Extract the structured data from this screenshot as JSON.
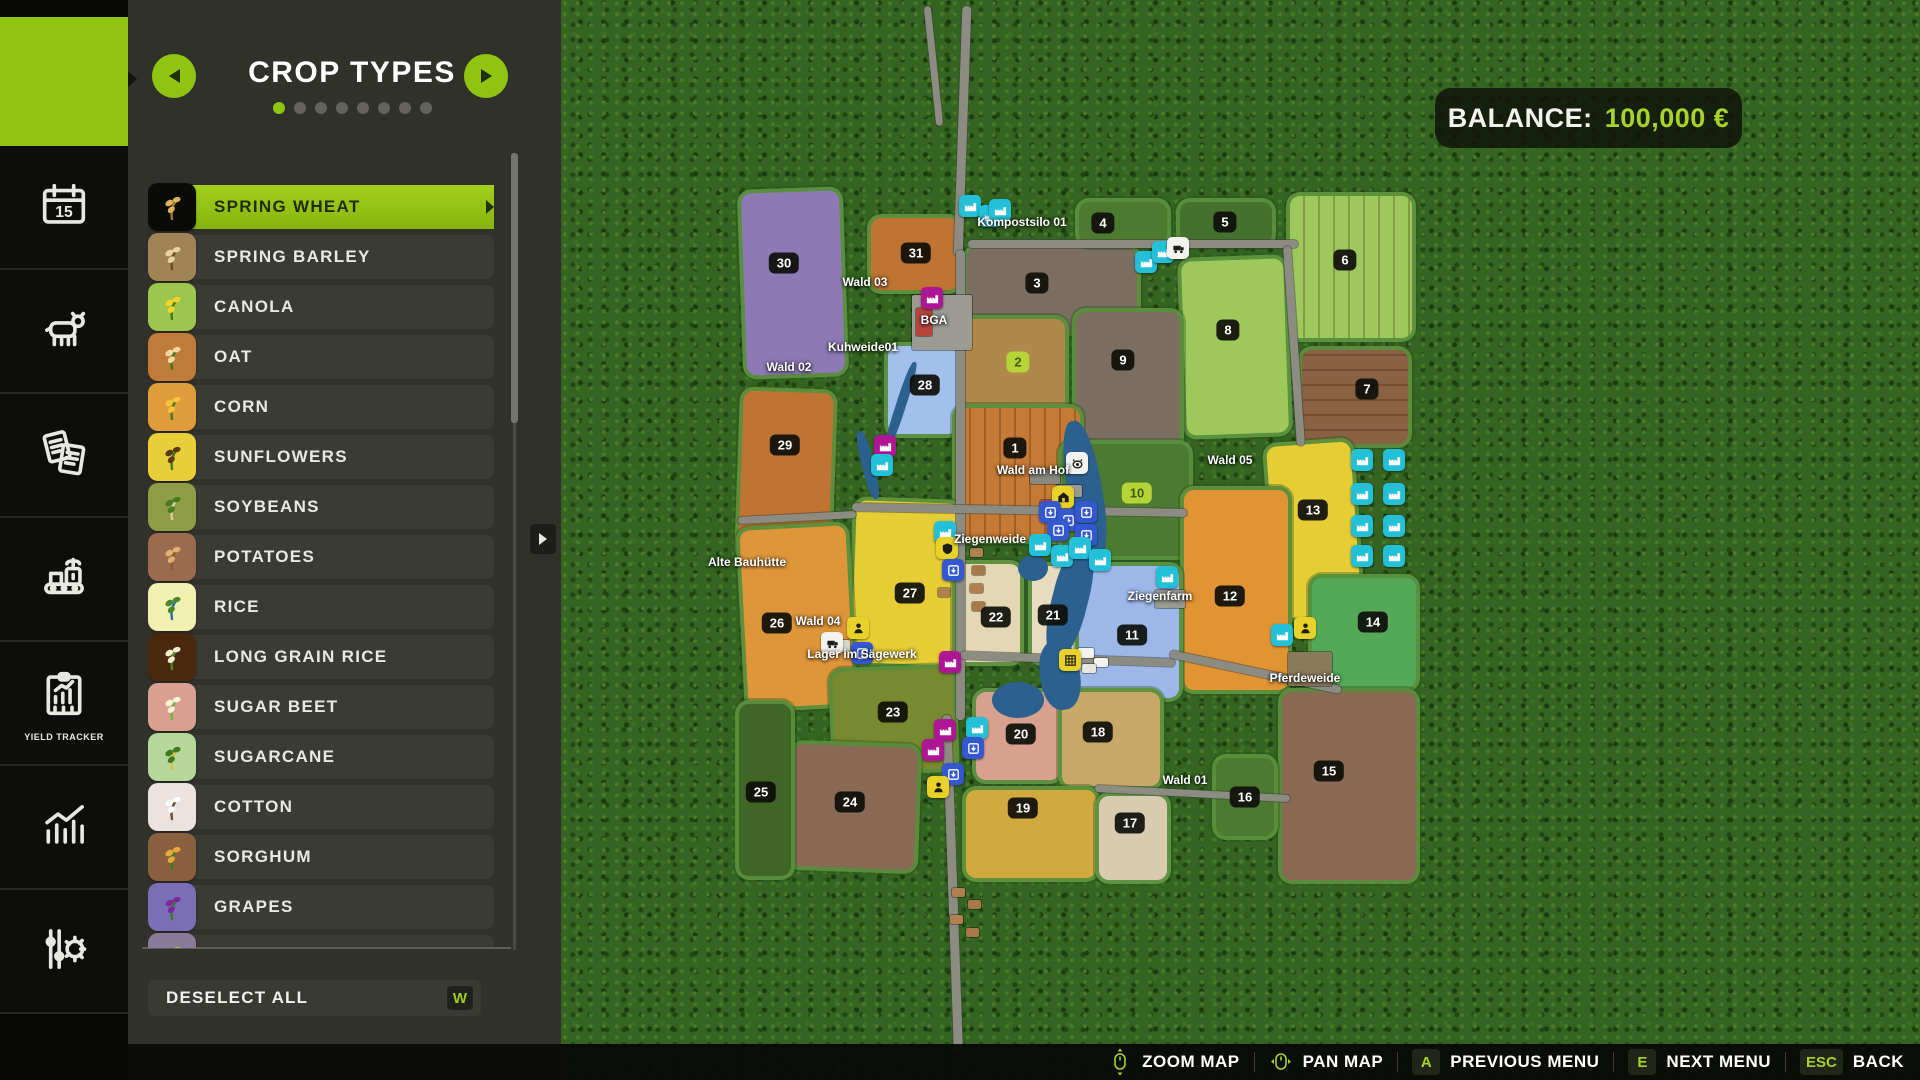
{
  "sidebar": {
    "items": [
      {
        "id": "map",
        "active": true
      },
      {
        "id": "calendar"
      },
      {
        "id": "animals"
      },
      {
        "id": "contracts"
      },
      {
        "id": "production"
      },
      {
        "id": "yield-tracker",
        "label": "YIELD TRACKER"
      },
      {
        "id": "statistics"
      },
      {
        "id": "settings"
      }
    ]
  },
  "panel": {
    "title": "CROP TYPES",
    "dots": {
      "count": 8,
      "active": 0
    },
    "accent": "#8fc412",
    "crops": [
      {
        "label": "SPRING WHEAT",
        "icon": "wheat-icon",
        "tile": "#0a0a08",
        "accent": "#d8b35a",
        "accent2": "#a07c2a",
        "selected": true
      },
      {
        "label": "SPRING BARLEY",
        "icon": "barley-icon",
        "tile": "#a08455",
        "accent": "#e9d3a0",
        "accent2": "#6b4e1e"
      },
      {
        "label": "CANOLA",
        "icon": "canola-icon",
        "tile": "#9dc64f",
        "accent": "#f5d42a",
        "accent2": "#3f7a1f"
      },
      {
        "label": "OAT",
        "icon": "oat-icon",
        "tile": "#c07a3a",
        "accent": "#f0d9a0",
        "accent2": "#3f7a1f"
      },
      {
        "label": "CORN",
        "icon": "corn-icon",
        "tile": "#e09b3a",
        "accent": "#f7c43a",
        "accent2": "#3f7a1f"
      },
      {
        "label": "SUNFLOWERS",
        "icon": "sunflower-icon",
        "tile": "#e8cf3a",
        "accent": "#5a3a10",
        "accent2": "#3f7a1f"
      },
      {
        "label": "SOYBEANS",
        "icon": "soybean-icon",
        "tile": "#8f9e44",
        "accent": "#4a7a1f",
        "accent2": "#d9cfa0"
      },
      {
        "label": "POTATOES",
        "icon": "potato-icon",
        "tile": "#9c6b4f",
        "accent": "#e0b070",
        "accent2": "#8a5a28"
      },
      {
        "label": "RICE",
        "icon": "rice-icon",
        "tile": "#f2f0b0",
        "accent": "#4a8a2a",
        "accent2": "#2a6ab0"
      },
      {
        "label": "LONG GRAIN RICE",
        "icon": "long-grain-rice-icon",
        "tile": "#4a2810",
        "accent": "#f0eecc",
        "accent2": "#4a8a2a"
      },
      {
        "label": "SUGAR BEET",
        "icon": "sugar-beet-icon",
        "tile": "#d9a091",
        "accent": "#f7f3d9",
        "accent2": "#7ab040"
      },
      {
        "label": "SUGARCANE",
        "icon": "sugarcane-icon",
        "tile": "#b5d89a",
        "accent": "#3f7a1f",
        "accent2": "#d9c040"
      },
      {
        "label": "COTTON",
        "icon": "cotton-icon",
        "tile": "#ece2e0",
        "accent": "#ffffff",
        "accent2": "#6b4e2e"
      },
      {
        "label": "SORGHUM",
        "icon": "sorghum-icon",
        "tile": "#8a5f3f",
        "accent": "#e8a83a",
        "accent2": "#3f7a1f"
      },
      {
        "label": "GRAPES",
        "icon": "grapes-icon",
        "tile": "#7a6fb5",
        "accent": "#7a2a9a",
        "accent2": "#3f7a1f"
      },
      {
        "label": "OLIVES",
        "icon": "olives-icon",
        "tile": "#8a7a9a",
        "accent": "#b8c030",
        "accent2": "#3f7a1f"
      }
    ],
    "deselect_label": "DESELECT ALL",
    "deselect_key": "W"
  },
  "balance": {
    "label": "BALANCE:",
    "value": "100,000 €",
    "value_color": "#a6d32a"
  },
  "bottom_bar": {
    "items": [
      {
        "icon": "mouse-zoom-icon",
        "label": "ZOOM MAP"
      },
      {
        "icon": "mouse-pan-icon",
        "label": "PAN MAP"
      },
      {
        "key": "A",
        "label": "PREVIOUS MENU"
      },
      {
        "key": "E",
        "label": "NEXT MENU"
      },
      {
        "key": "ESC",
        "label": "BACK"
      }
    ]
  },
  "map": {
    "fields": [
      {
        "n": "30",
        "x": 740,
        "y": 188,
        "w": 106,
        "h": 190,
        "c": "#8d7ab5",
        "bx": 784,
        "by": 263,
        "rot": -2
      },
      {
        "n": "31",
        "x": 867,
        "y": 214,
        "w": 95,
        "h": 80,
        "c": "#c07433",
        "bx": 916,
        "by": 253
      },
      {
        "n": "3",
        "x": 963,
        "y": 244,
        "w": 178,
        "h": 92,
        "c": "#7b6f62",
        "bx": 1037,
        "by": 283
      },
      {
        "n": "4",
        "x": 1075,
        "y": 198,
        "w": 96,
        "h": 50,
        "c": "#4c7a31",
        "bx": 1103,
        "by": 223
      },
      {
        "n": "5",
        "x": 1176,
        "y": 198,
        "w": 100,
        "h": 50,
        "c": "#45702d",
        "bx": 1225,
        "by": 222
      },
      {
        "n": "6",
        "x": 1286,
        "y": 192,
        "w": 130,
        "h": 150,
        "c": "#9fc85c",
        "bx": 1345,
        "by": 260,
        "rows": "v"
      },
      {
        "n": "7",
        "x": 1298,
        "y": 346,
        "w": 114,
        "h": 102,
        "c": "#8a6142",
        "bx": 1367,
        "by": 389,
        "rows": "h"
      },
      {
        "n": "8",
        "x": 1180,
        "y": 256,
        "w": 110,
        "h": 182,
        "c": "#9fc85c",
        "bx": 1228,
        "by": 330,
        "rot": -2
      },
      {
        "n": "9",
        "x": 1072,
        "y": 308,
        "w": 112,
        "h": 146,
        "c": "#7b6f62",
        "bx": 1123,
        "by": 360
      },
      {
        "n": "2",
        "x": 955,
        "y": 315,
        "w": 114,
        "h": 118,
        "c": "#b0894a",
        "bx": 1018,
        "by": 362,
        "g": 1
      },
      {
        "n": "28",
        "x": 884,
        "y": 342,
        "w": 78,
        "h": 96,
        "c": "#a3bfec",
        "bx": 925,
        "by": 385
      },
      {
        "n": "29",
        "x": 737,
        "y": 388,
        "w": 98,
        "h": 175,
        "c": "#c07433",
        "bx": 785,
        "by": 445,
        "rot": 2
      },
      {
        "n": "1",
        "x": 952,
        "y": 404,
        "w": 132,
        "h": 140,
        "c": "#c57a35",
        "bx": 1015,
        "by": 448,
        "rows": "v"
      },
      {
        "n": "10",
        "x": 1058,
        "y": 440,
        "w": 135,
        "h": 120,
        "c": "#4c7a31",
        "bx": 1137,
        "by": 493,
        "g": 1
      },
      {
        "n": "13",
        "x": 1268,
        "y": 440,
        "w": 92,
        "h": 180,
        "c": "#e6cd36",
        "bx": 1313,
        "by": 510,
        "rot": -4
      },
      {
        "n": "12",
        "x": 1180,
        "y": 486,
        "w": 112,
        "h": 208,
        "c": "#e09434",
        "bx": 1230,
        "by": 596
      },
      {
        "n": "27",
        "x": 850,
        "y": 498,
        "w": 110,
        "h": 170,
        "c": "#e6cd36",
        "bx": 910,
        "by": 593,
        "rot": 2
      },
      {
        "n": "26",
        "x": 740,
        "y": 524,
        "w": 114,
        "h": 186,
        "c": "#df963a",
        "bx": 777,
        "by": 623,
        "rot": -3
      },
      {
        "n": "22",
        "x": 952,
        "y": 560,
        "w": 72,
        "h": 106,
        "c": "#e4d7b5",
        "bx": 996,
        "by": 617
      },
      {
        "n": "21",
        "x": 1028,
        "y": 562,
        "w": 52,
        "h": 104,
        "c": "#e8dcc0",
        "bx": 1053,
        "by": 615
      },
      {
        "n": "11",
        "x": 1075,
        "y": 562,
        "w": 108,
        "h": 140,
        "c": "#9db8e8",
        "bx": 1132,
        "by": 635
      },
      {
        "n": "14",
        "x": 1308,
        "y": 574,
        "w": 112,
        "h": 118,
        "c": "#55a858",
        "bx": 1373,
        "by": 622
      },
      {
        "n": "23",
        "x": 830,
        "y": 666,
        "w": 128,
        "h": 108,
        "c": "#78892f",
        "bx": 893,
        "by": 712,
        "rot": -2
      },
      {
        "n": "20",
        "x": 972,
        "y": 688,
        "w": 92,
        "h": 96,
        "c": "#d8a08f",
        "bx": 1021,
        "by": 734
      },
      {
        "n": "18",
        "x": 1058,
        "y": 688,
        "w": 106,
        "h": 102,
        "c": "#c8a869",
        "bx": 1098,
        "by": 732
      },
      {
        "n": "15",
        "x": 1278,
        "y": 688,
        "w": 142,
        "h": 196,
        "c": "#8a6a55",
        "bx": 1329,
        "by": 771
      },
      {
        "n": "16",
        "x": 1212,
        "y": 754,
        "w": 66,
        "h": 86,
        "c": "#4c7a31",
        "bx": 1245,
        "by": 797
      },
      {
        "n": "24",
        "x": 788,
        "y": 742,
        "w": 132,
        "h": 130,
        "c": "#8a6a55",
        "bx": 850,
        "by": 802,
        "rot": 2
      },
      {
        "n": "25",
        "x": 735,
        "y": 700,
        "w": 60,
        "h": 180,
        "c": "#3f6527",
        "bx": 761,
        "by": 792
      },
      {
        "n": "19",
        "x": 962,
        "y": 786,
        "w": 138,
        "h": 96,
        "c": "#d0a93f",
        "bx": 1023,
        "by": 808
      },
      {
        "n": "17",
        "x": 1095,
        "y": 792,
        "w": 76,
        "h": 92,
        "c": "#d9cbb0",
        "bx": 1130,
        "by": 823
      }
    ],
    "labels": [
      {
        "text": "Kompostsilo 01",
        "x": 1022,
        "y": 222
      },
      {
        "text": "Wald 03",
        "x": 865,
        "y": 282
      },
      {
        "text": "BGA",
        "x": 934,
        "y": 320
      },
      {
        "text": "Kuhweide01",
        "x": 863,
        "y": 347
      },
      {
        "text": "Wald 02",
        "x": 789,
        "y": 367
      },
      {
        "text": "Wald am Hof",
        "x": 1033,
        "y": 470
      },
      {
        "text": "Wald 05",
        "x": 1230,
        "y": 460
      },
      {
        "text": "Ziegenweide",
        "x": 990,
        "y": 539
      },
      {
        "text": "Ziegenfarm",
        "x": 1160,
        "y": 596
      },
      {
        "text": "Alte Bauhütte",
        "x": 747,
        "y": 562
      },
      {
        "text": "Wald 04",
        "x": 818,
        "y": 621
      },
      {
        "text": "Lager im Sägewerk",
        "x": 862,
        "y": 654
      },
      {
        "text": "Pferdeweide",
        "x": 1305,
        "y": 678
      },
      {
        "text": "Wald 01",
        "x": 1185,
        "y": 780
      }
    ],
    "icon_colors": {
      "teal": "#23c0d8",
      "blue": "#3458cf",
      "magenta": "#ae1695",
      "yellow": "#e8d22a",
      "white": "#f2f2ee"
    },
    "icons": [
      {
        "t": "production",
        "c": "teal",
        "x": 970,
        "y": 206
      },
      {
        "t": "production",
        "c": "teal",
        "x": 990,
        "y": 216
      },
      {
        "t": "production",
        "c": "teal",
        "x": 1000,
        "y": 210
      },
      {
        "t": "production",
        "c": "teal",
        "x": 1146,
        "y": 262
      },
      {
        "t": "production",
        "c": "teal",
        "x": 1163,
        "y": 252
      },
      {
        "t": "vehicle",
        "c": "white",
        "x": 1178,
        "y": 248
      },
      {
        "t": "biogas",
        "c": "magenta",
        "x": 932,
        "y": 298
      },
      {
        "t": "biogas",
        "c": "magenta",
        "x": 885,
        "y": 446
      },
      {
        "t": "production",
        "c": "teal",
        "x": 882,
        "y": 465
      },
      {
        "t": "production",
        "c": "teal",
        "x": 945,
        "y": 532
      },
      {
        "t": "security",
        "c": "yellow",
        "x": 947,
        "y": 548
      },
      {
        "t": "storage",
        "c": "blue",
        "x": 953,
        "y": 570
      },
      {
        "t": "animal-pen",
        "c": "white",
        "x": 1077,
        "y": 463
      },
      {
        "t": "farmhouse",
        "c": "yellow",
        "x": 1063,
        "y": 497
      },
      {
        "t": "storage",
        "c": "blue",
        "x": 1050,
        "y": 512
      },
      {
        "t": "storage",
        "c": "blue",
        "x": 1068,
        "y": 520
      },
      {
        "t": "storage",
        "c": "blue",
        "x": 1086,
        "y": 512
      },
      {
        "t": "storage",
        "c": "blue",
        "x": 1058,
        "y": 530
      },
      {
        "t": "storage",
        "c": "blue",
        "x": 1086,
        "y": 535
      },
      {
        "t": "production",
        "c": "teal",
        "x": 1040,
        "y": 545
      },
      {
        "t": "production",
        "c": "teal",
        "x": 1062,
        "y": 556
      },
      {
        "t": "production",
        "c": "teal",
        "x": 1080,
        "y": 548
      },
      {
        "t": "production",
        "c": "teal",
        "x": 1100,
        "y": 560
      },
      {
        "t": "production",
        "c": "teal",
        "x": 1167,
        "y": 577
      },
      {
        "t": "worker",
        "c": "yellow",
        "x": 858,
        "y": 628
      },
      {
        "t": "storage",
        "c": "blue",
        "x": 862,
        "y": 653
      },
      {
        "t": "vehicle",
        "c": "white",
        "x": 832,
        "y": 643
      },
      {
        "t": "biogas",
        "c": "magenta",
        "x": 950,
        "y": 662
      },
      {
        "t": "biogas",
        "c": "magenta",
        "x": 945,
        "y": 730
      },
      {
        "t": "biogas",
        "c": "magenta",
        "x": 933,
        "y": 750
      },
      {
        "t": "production",
        "c": "teal",
        "x": 977,
        "y": 728
      },
      {
        "t": "storage",
        "c": "blue",
        "x": 973,
        "y": 748
      },
      {
        "t": "storage",
        "c": "blue",
        "x": 953,
        "y": 774
      },
      {
        "t": "worker",
        "c": "yellow",
        "x": 938,
        "y": 787
      },
      {
        "t": "solar",
        "c": "yellow",
        "x": 1070,
        "y": 660
      },
      {
        "t": "production",
        "c": "teal",
        "x": 1282,
        "y": 635
      },
      {
        "t": "worker",
        "c": "yellow",
        "x": 1305,
        "y": 628
      },
      {
        "t": "production",
        "c": "teal",
        "x": 1362,
        "y": 460
      },
      {
        "t": "production",
        "c": "teal",
        "x": 1394,
        "y": 460
      },
      {
        "t": "production",
        "c": "teal",
        "x": 1362,
        "y": 494
      },
      {
        "t": "production",
        "c": "teal",
        "x": 1394,
        "y": 494
      },
      {
        "t": "production",
        "c": "teal",
        "x": 1362,
        "y": 526
      },
      {
        "t": "production",
        "c": "teal",
        "x": 1394,
        "y": 526
      },
      {
        "t": "production",
        "c": "teal",
        "x": 1362,
        "y": 556
      },
      {
        "t": "production",
        "c": "teal",
        "x": 1394,
        "y": 556
      }
    ],
    "roads": [
      {
        "x": 958,
        "y": 6,
        "w": 9,
        "h": 250,
        "rot": 2
      },
      {
        "x": 956,
        "y": 250,
        "w": 9,
        "h": 470,
        "rot": 0
      },
      {
        "x": 948,
        "y": 715,
        "w": 9,
        "h": 335,
        "rot": -2
      },
      {
        "x": 930,
        "y": 6,
        "w": 7,
        "h": 120,
        "rot": -6
      },
      {
        "x": 852,
        "y": 506,
        "w": 335,
        "h": 8,
        "rot": 1
      },
      {
        "x": 738,
        "y": 514,
        "w": 118,
        "h": 7,
        "rot": -3
      },
      {
        "x": 960,
        "y": 655,
        "w": 215,
        "h": 8,
        "rot": 2
      },
      {
        "x": 1168,
        "y": 668,
        "w": 175,
        "h": 8,
        "rot": 12
      },
      {
        "x": 968,
        "y": 240,
        "w": 330,
        "h": 8,
        "rot": 0
      },
      {
        "x": 1290,
        "y": 246,
        "w": 8,
        "h": 200,
        "rot": -4
      },
      {
        "x": 1095,
        "y": 790,
        "w": 195,
        "h": 7,
        "rot": 3
      }
    ],
    "water": [
      {
        "x": 1068,
        "y": 420,
        "w": 34,
        "h": 140,
        "rot": -10,
        "r": "45%"
      },
      {
        "x": 1052,
        "y": 540,
        "w": 36,
        "h": 120,
        "rot": 14,
        "r": "45%"
      },
      {
        "x": 1040,
        "y": 640,
        "w": 40,
        "h": 70,
        "rot": -8,
        "r": "45%"
      },
      {
        "x": 992,
        "y": 682,
        "w": 52,
        "h": 36,
        "rot": 0,
        "r": "50%"
      },
      {
        "x": 1018,
        "y": 555,
        "w": 30,
        "h": 26,
        "rot": 0,
        "r": "50%"
      },
      {
        "x": 896,
        "y": 360,
        "w": 10,
        "h": 90,
        "rot": 18,
        "r": "40%"
      },
      {
        "x": 862,
        "y": 430,
        "w": 12,
        "h": 70,
        "rot": -14,
        "r": "40%"
      }
    ],
    "buildings": [
      {
        "x": 912,
        "y": 295,
        "w": 60,
        "h": 55,
        "c": "#9b9b93"
      },
      {
        "x": 916,
        "y": 308,
        "w": 16,
        "h": 28,
        "c": "#b8443c"
      },
      {
        "x": 970,
        "y": 548,
        "w": 13,
        "h": 9,
        "c": "#b08050"
      },
      {
        "x": 972,
        "y": 566,
        "w": 13,
        "h": 9,
        "c": "#a87848"
      },
      {
        "x": 970,
        "y": 584,
        "w": 13,
        "h": 9,
        "c": "#b08050"
      },
      {
        "x": 972,
        "y": 602,
        "w": 13,
        "h": 9,
        "c": "#a87848"
      },
      {
        "x": 938,
        "y": 588,
        "w": 12,
        "h": 9,
        "c": "#b08050"
      },
      {
        "x": 952,
        "y": 888,
        "w": 13,
        "h": 9,
        "c": "#b08050"
      },
      {
        "x": 968,
        "y": 900,
        "w": 13,
        "h": 9,
        "c": "#a87848"
      },
      {
        "x": 950,
        "y": 915,
        "w": 13,
        "h": 9,
        "c": "#b08050"
      },
      {
        "x": 966,
        "y": 928,
        "w": 13,
        "h": 9,
        "c": "#a87848"
      },
      {
        "x": 1030,
        "y": 470,
        "w": 30,
        "h": 14,
        "c": "#8a8a80"
      },
      {
        "x": 1056,
        "y": 485,
        "w": 26,
        "h": 12,
        "c": "#9b9b93"
      },
      {
        "x": 1040,
        "y": 500,
        "w": 18,
        "h": 10,
        "c": "#b8443c"
      },
      {
        "x": 1155,
        "y": 590,
        "w": 30,
        "h": 18,
        "c": "#9b9b93"
      },
      {
        "x": 1288,
        "y": 652,
        "w": 44,
        "h": 34,
        "c": "#8a7a5a"
      },
      {
        "x": 1078,
        "y": 648,
        "w": 16,
        "h": 10,
        "c": "#f2f2ee"
      },
      {
        "x": 1094,
        "y": 658,
        "w": 14,
        "h": 9,
        "c": "#f2f2ee"
      },
      {
        "x": 1082,
        "y": 664,
        "w": 14,
        "h": 9,
        "c": "#e8e8e0"
      },
      {
        "x": 828,
        "y": 640,
        "w": 22,
        "h": 12,
        "c": "#d8d8d0"
      }
    ]
  }
}
